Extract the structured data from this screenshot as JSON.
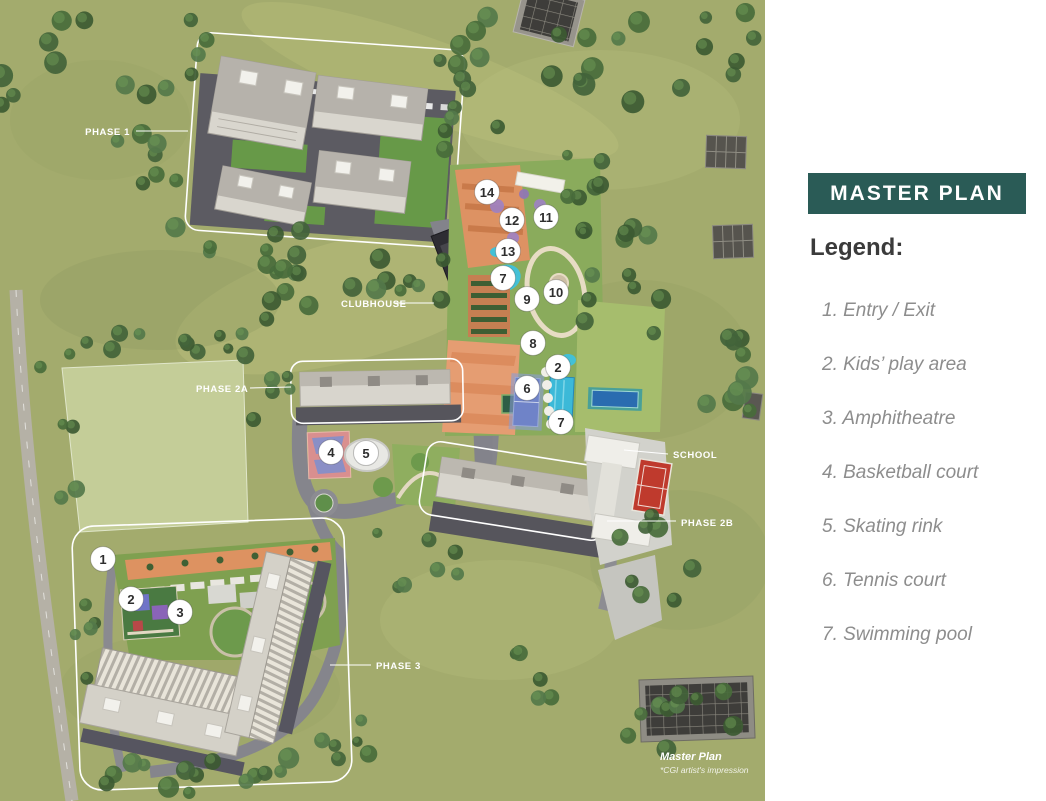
{
  "panel": {
    "title": "MASTER PLAN",
    "legend_heading": "Legend:",
    "accent_color": "#2a5b56",
    "legend_items": [
      {
        "number": "1",
        "label": "Entry / Exit"
      },
      {
        "number": "2",
        "label": "Kids’ play area"
      },
      {
        "number": "3",
        "label": "Amphitheatre"
      },
      {
        "number": "4",
        "label": "Basketball court"
      },
      {
        "number": "5",
        "label": "Skating rink"
      },
      {
        "number": "6",
        "label": "Tennis court"
      },
      {
        "number": "7",
        "label": "Swimming pool"
      }
    ]
  },
  "map": {
    "callouts": [
      {
        "text": "PHASE 1",
        "x": 130,
        "y": 135,
        "anchor": "end",
        "line": [
          136,
          131,
          188,
          131
        ]
      },
      {
        "text": "CLUBHOUSE",
        "x": 341,
        "y": 307,
        "anchor": "start",
        "line": [
          394,
          303,
          434,
          303
        ]
      },
      {
        "text": "PHASE 2A",
        "x": 196,
        "y": 392,
        "anchor": "start",
        "line": [
          250,
          388,
          291,
          387
        ]
      },
      {
        "text": "SCHOOL",
        "x": 673,
        "y": 458,
        "anchor": "start",
        "line": [
          624,
          450,
          668,
          454
        ]
      },
      {
        "text": "PHASE 2B",
        "x": 681,
        "y": 526,
        "anchor": "start",
        "line": [
          607,
          521,
          676,
          521
        ]
      },
      {
        "text": "PHASE 3",
        "x": 376,
        "y": 669,
        "anchor": "start",
        "line": [
          330,
          665,
          371,
          665
        ]
      }
    ],
    "markers": [
      {
        "n": "14",
        "x": 487,
        "y": 192
      },
      {
        "n": "12",
        "x": 512,
        "y": 220
      },
      {
        "n": "11",
        "x": 546,
        "y": 217
      },
      {
        "n": "13",
        "x": 508,
        "y": 251
      },
      {
        "n": "7",
        "x": 503,
        "y": 278
      },
      {
        "n": "9",
        "x": 527,
        "y": 299
      },
      {
        "n": "10",
        "x": 556,
        "y": 292
      },
      {
        "n": "8",
        "x": 533,
        "y": 343
      },
      {
        "n": "2",
        "x": 558,
        "y": 367
      },
      {
        "n": "6",
        "x": 527,
        "y": 388
      },
      {
        "n": "7",
        "x": 561,
        "y": 422
      },
      {
        "n": "4",
        "x": 331,
        "y": 452
      },
      {
        "n": "5",
        "x": 366,
        "y": 453
      },
      {
        "n": "1",
        "x": 103,
        "y": 559
      },
      {
        "n": "2",
        "x": 131,
        "y": 599
      },
      {
        "n": "3",
        "x": 180,
        "y": 612
      }
    ],
    "footnote": {
      "title": "Master Plan",
      "note": "*CGI artist's impression",
      "x": 660,
      "y": 760
    }
  }
}
